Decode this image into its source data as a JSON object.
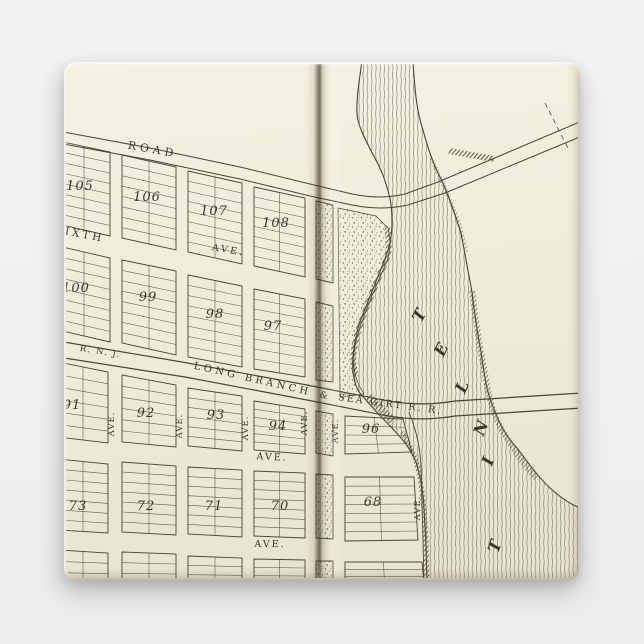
{
  "scene": {
    "background_color": "#f0f0f1",
    "paper_color": "#eeebd9",
    "ink_color": "#4a4536",
    "fold_color": "#3f3217",
    "water_line_color": "#6e6954"
  },
  "map": {
    "road_label": "ROAD",
    "sixth_street_label": "IXTH",
    "sixth_ave_label": "AVE.",
    "railroad_left_label": "R. N. J.",
    "railroad_label_1": "LONG BRANCH",
    "railroad_ampersand": "&",
    "railroad_label_2": "SEA GIRT R. R.",
    "mid_avenue_label": "AVE.",
    "bottom_avenue_label": "AVE.",
    "vertical_avenue_label": "AVE.",
    "river_label_letters": [
      "T",
      "E",
      "L",
      "N",
      "I",
      "T"
    ],
    "block_numbers": {
      "105": "105",
      "106": "106",
      "107": "107",
      "108": "108",
      "100": "100",
      "99": "99",
      "98": "98",
      "97": "97",
      "91": "91",
      "92": "92",
      "93": "93",
      "94": "94",
      "96": "96",
      "73": "73",
      "72": "72",
      "71": "71",
      "70": "70",
      "68": "68"
    }
  }
}
